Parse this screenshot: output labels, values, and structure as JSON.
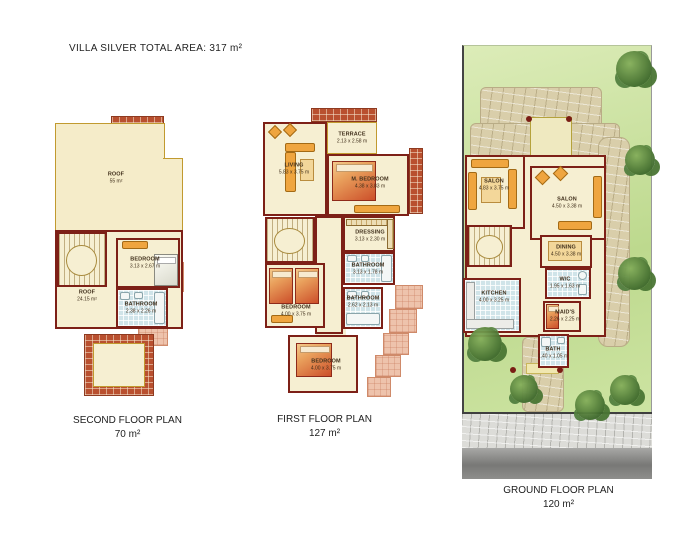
{
  "title": {
    "name": "VILLA SILVER",
    "total_area": "TOTAL AREA: 317 m²"
  },
  "plans": {
    "second": {
      "label": "SECOND FLOOR PLAN",
      "area": "70 m²",
      "rooms": {
        "roof_upper": {
          "name": "ROOF",
          "dims": "55 m²"
        },
        "roof_lower": {
          "name": "ROOF",
          "dims": "24.15 m²"
        },
        "bedroom": {
          "name": "BEDROOM",
          "dims": "3.13 x 2.67 m"
        },
        "bathroom": {
          "name": "BATHROOM",
          "dims": "2.38 x 2.26 m"
        }
      }
    },
    "first": {
      "label": "FIRST FLOOR PLAN",
      "area": "127 m²",
      "rooms": {
        "terrace": {
          "name": "TERRACE",
          "dims": "2.13 x 2.58 m"
        },
        "living": {
          "name": "LIVING",
          "dims": "5.83 x 3.75 m"
        },
        "master_bedroom": {
          "name": "M. BEDROOM",
          "dims": "4.38 x 3.83 m"
        },
        "dressing": {
          "name": "DRESSING",
          "dims": "3.13 x 2.30 m"
        },
        "bathroom_upper": {
          "name": "BATHROOM",
          "dims": "3.13 x 1.78 m"
        },
        "bedroom_middle": {
          "name": "BEDROOM",
          "dims": "4.00 x 3.75 m"
        },
        "bathroom_lower": {
          "name": "BATHROOM",
          "dims": "2.62 x 2.13 m"
        },
        "bedroom_lower": {
          "name": "BEDROOM",
          "dims": "4.00 x 3.75 m"
        }
      }
    },
    "ground": {
      "label": "GROUND FLOOR PLAN",
      "area": "120 m²",
      "rooms": {
        "salon_left": {
          "name": "SALON",
          "dims": "4.83 x 3.75 m"
        },
        "salon_right": {
          "name": "SALON",
          "dims": "4.50 x 3.38 m"
        },
        "dining": {
          "name": "DINING",
          "dims": "4.50 x 3.38 m"
        },
        "kitchen": {
          "name": "KITCHEN",
          "dims": "4.00 x 3.25 m"
        },
        "wc": {
          "name": "W/C",
          "dims": "1.95 x 1.63 m"
        },
        "maids": {
          "name": "MAID'S",
          "dims": "2.26 x 2.25 m"
        },
        "bath": {
          "name": "BATH",
          "dims": "1.40 x 1.05 m"
        }
      }
    }
  },
  "colors": {
    "wall": "#7d2017",
    "floor": "#f6efd2",
    "roof": "#f5ecc9",
    "tile_blue": "#d0e4e9",
    "brick": "#b9502f",
    "salmon": "#eec3ac",
    "lawn": "#c8dd9b",
    "stone": "#d9ceaa",
    "furniture_orange": "#efa53f",
    "sidewalk": "#dcdcd8",
    "road": "#8a8a88"
  }
}
